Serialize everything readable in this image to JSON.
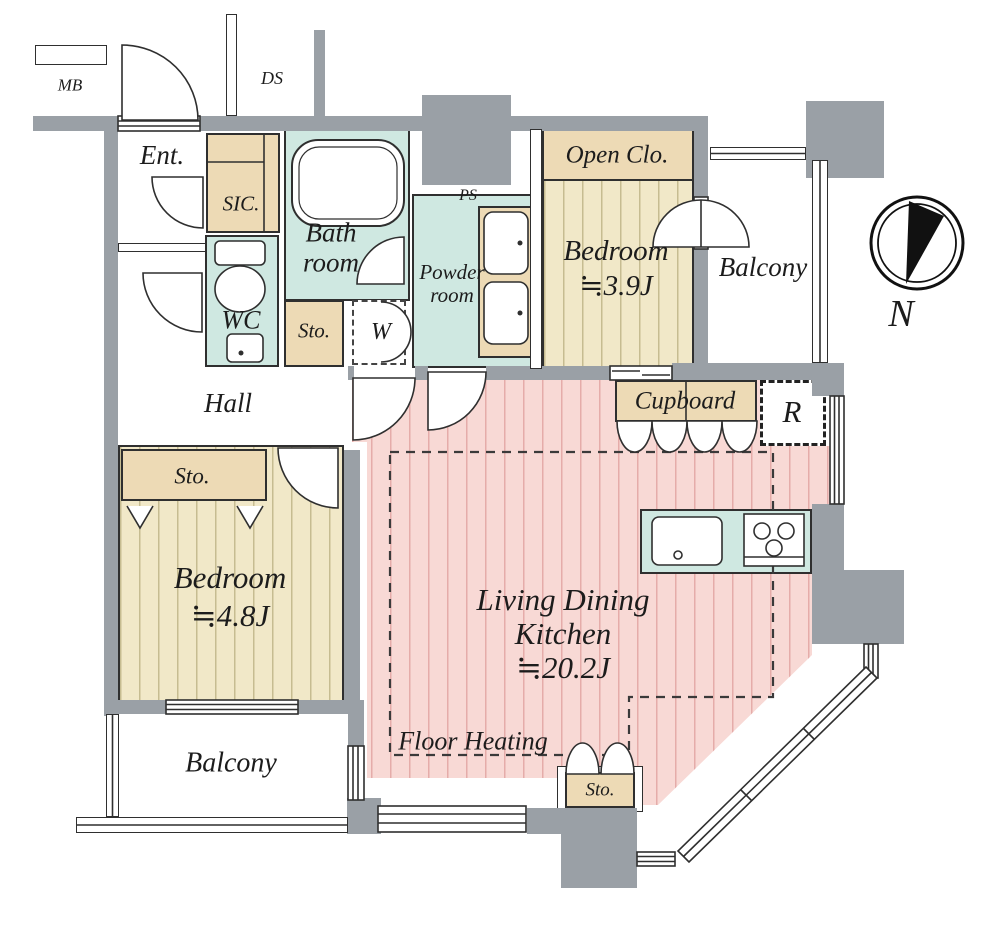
{
  "plan": {
    "type": "apartment-floor-plan",
    "compass": {
      "label": "N"
    },
    "colors": {
      "wall": "#9aa0a6",
      "closet_tan": "#eddab5",
      "bedroom_floor": "#f1e8c8",
      "ldk_floor": "#f8d9d5",
      "wet_area_teal": "#cfe8e1",
      "line": "#2f2f2f"
    },
    "rooms": {
      "mb": {
        "label": "MB"
      },
      "ds": {
        "label": "DS"
      },
      "entrance": {
        "label": "Ent."
      },
      "sic": {
        "label": "SIC."
      },
      "bathroom": {
        "label_line1": "Bath",
        "label_line2": "room"
      },
      "wc": {
        "label": "WC"
      },
      "storage_bath": {
        "label": "Sto."
      },
      "washer": {
        "label": "W"
      },
      "powder_room": {
        "label_line1": "Powder",
        "label_line2": "room"
      },
      "ps": {
        "label": "PS"
      },
      "open_closet": {
        "label": "Open Clo."
      },
      "bedroom1": {
        "label": "Bedroom",
        "area": "≒3.9J"
      },
      "balcony_right": {
        "label": "Balcony"
      },
      "cupboard": {
        "label": "Cupboard"
      },
      "refrigerator": {
        "label": "R"
      },
      "hall": {
        "label": "Hall"
      },
      "storage_hall": {
        "label": "Sto."
      },
      "bedroom2": {
        "label": "Bedroom",
        "area": "≒4.8J"
      },
      "balcony_bottom": {
        "label": "Balcony"
      },
      "ldk": {
        "label_line1": "Living Dining",
        "label_line2": "Kitchen",
        "area": "≒20.2J"
      },
      "floor_heating": {
        "label": "Floor Heating"
      },
      "storage_ldk": {
        "label": "Sto."
      }
    }
  }
}
